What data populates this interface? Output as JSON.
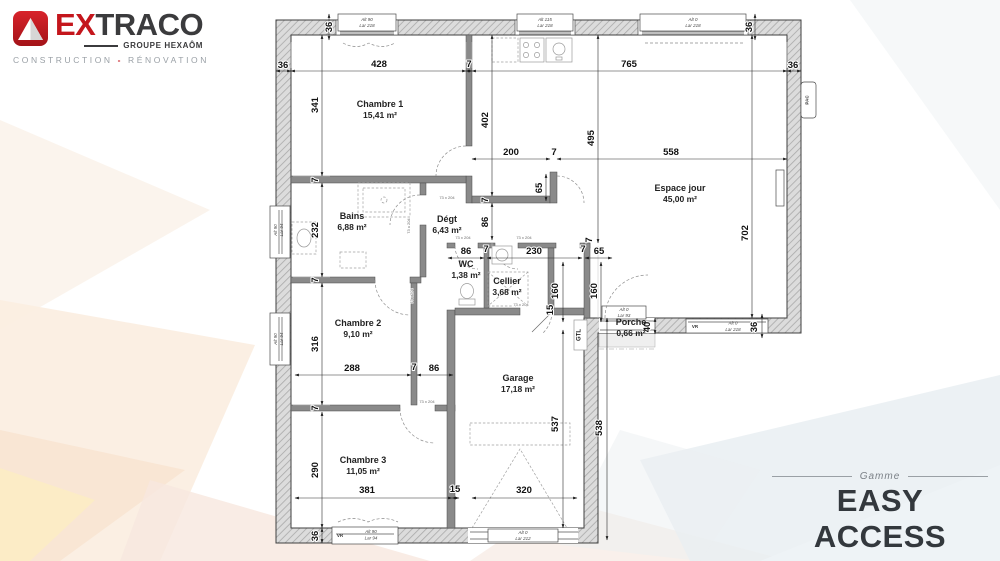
{
  "brand": {
    "name_accent": "EX",
    "name_rest": "TRACO",
    "group": "GROUPE HEXAÔM",
    "tagline_left": "CONSTRUCTION",
    "tagline_sep": "-",
    "tagline_right": "RÉNOVATION"
  },
  "range": {
    "label": "Gamme",
    "name": "EASY ACCESS"
  },
  "colors": {
    "brand_red": "#c4161c",
    "text_dark": "#33383d",
    "wall_gray": "#dcdcdc",
    "dim_text": "#111111"
  },
  "plan": {
    "rooms": [
      {
        "name": "Chambre 1",
        "area": "15,41 m²",
        "x": 380,
        "y": 107
      },
      {
        "name": "Espace jour",
        "area": "45,00 m²",
        "x": 680,
        "y": 191
      },
      {
        "name": "Bains",
        "area": "6,88 m²",
        "x": 352,
        "y": 219
      },
      {
        "name": "Dégt",
        "area": "6,43 m²",
        "x": 447,
        "y": 222
      },
      {
        "name": "WC",
        "area": "1,38 m²",
        "x": 466,
        "y": 267
      },
      {
        "name": "Cellier",
        "area": "3,68 m²",
        "x": 507,
        "y": 284
      },
      {
        "name": "Chambre 2",
        "area": "9,10 m²",
        "x": 358,
        "y": 326
      },
      {
        "name": "Garage",
        "area": "17,18 m²",
        "x": 518,
        "y": 381
      },
      {
        "name": "Chambre 3",
        "area": "11,05 m²",
        "x": 363,
        "y": 463
      },
      {
        "name": "Porche",
        "area": "0,66 m²",
        "x": 631,
        "y": 325
      }
    ],
    "dimensions": [
      {
        "t": "36",
        "x": 283,
        "y": 68
      },
      {
        "t": "428",
        "x": 379,
        "y": 67
      },
      {
        "t": "7",
        "x": 469,
        "y": 67
      },
      {
        "t": "765",
        "x": 629,
        "y": 67
      },
      {
        "t": "36",
        "x": 793,
        "y": 68
      },
      {
        "t": "36",
        "x": 332,
        "y": 27,
        "r": 1
      },
      {
        "t": "36",
        "x": 752,
        "y": 27,
        "r": 1
      },
      {
        "t": "341",
        "x": 318,
        "y": 105,
        "r": 1
      },
      {
        "t": "7",
        "x": 318,
        "y": 180,
        "r": 1
      },
      {
        "t": "232",
        "x": 318,
        "y": 230,
        "r": 1
      },
      {
        "t": "7",
        "x": 318,
        "y": 280,
        "r": 1
      },
      {
        "t": "316",
        "x": 318,
        "y": 344,
        "r": 1
      },
      {
        "t": "7",
        "x": 318,
        "y": 408,
        "r": 1
      },
      {
        "t": "290",
        "x": 318,
        "y": 470,
        "r": 1
      },
      {
        "t": "36",
        "x": 318,
        "y": 536,
        "r": 1
      },
      {
        "t": "402",
        "x": 488,
        "y": 120,
        "r": 1
      },
      {
        "t": "7",
        "x": 488,
        "y": 200,
        "r": 1
      },
      {
        "t": "86",
        "x": 488,
        "y": 222,
        "r": 1
      },
      {
        "t": "495",
        "x": 594,
        "y": 138,
        "r": 1
      },
      {
        "t": "200",
        "x": 511,
        "y": 155
      },
      {
        "t": "7",
        "x": 554,
        "y": 155
      },
      {
        "t": "558",
        "x": 671,
        "y": 155
      },
      {
        "t": "65",
        "x": 542,
        "y": 188,
        "r": 1
      },
      {
        "t": "86",
        "x": 466,
        "y": 254
      },
      {
        "t": "7",
        "x": 486,
        "y": 252
      },
      {
        "t": "230",
        "x": 534,
        "y": 254
      },
      {
        "t": "7",
        "x": 583,
        "y": 252
      },
      {
        "t": "65",
        "x": 599,
        "y": 254
      },
      {
        "t": "160",
        "x": 558,
        "y": 291,
        "r": 1
      },
      {
        "t": "160",
        "x": 597,
        "y": 291,
        "r": 1
      },
      {
        "t": "15",
        "x": 553,
        "y": 310,
        "r": 1
      },
      {
        "t": "7",
        "x": 592,
        "y": 240,
        "r": 1
      },
      {
        "t": "288",
        "x": 352,
        "y": 371
      },
      {
        "t": "7",
        "x": 414,
        "y": 370
      },
      {
        "t": "86",
        "x": 434,
        "y": 371
      },
      {
        "t": "381",
        "x": 367,
        "y": 493
      },
      {
        "t": "15",
        "x": 455,
        "y": 492
      },
      {
        "t": "320",
        "x": 524,
        "y": 493
      },
      {
        "t": "537",
        "x": 558,
        "y": 424,
        "r": 1
      },
      {
        "t": "538",
        "x": 602,
        "y": 428,
        "r": 1
      },
      {
        "t": "702",
        "x": 748,
        "y": 233,
        "r": 1
      },
      {
        "t": "40",
        "x": 650,
        "y": 327,
        "r": 1
      },
      {
        "t": "36",
        "x": 757,
        "y": 327,
        "r": 1
      }
    ],
    "door_labels": [
      {
        "t": "73 x 204",
        "x": 447,
        "y": 199
      },
      {
        "t": "73 x 204",
        "x": 410,
        "y": 226,
        "r": 1
      },
      {
        "t": "73 x 204",
        "x": 413,
        "y": 296,
        "r": 1
      },
      {
        "t": "73 x 204",
        "x": 463,
        "y": 239
      },
      {
        "t": "73 x 204",
        "x": 524,
        "y": 239
      },
      {
        "t": "73 x 204",
        "x": 427,
        "y": 403
      },
      {
        "t": "73 x 204",
        "x": 521,
        "y": 306
      }
    ],
    "small_labels": [
      {
        "t": "Alt 90",
        "x": 367,
        "y": 21
      },
      {
        "t": "Lar 218",
        "x": 367,
        "y": 27
      },
      {
        "t": "Alt 115",
        "x": 545,
        "y": 21
      },
      {
        "t": "Lar 218",
        "x": 545,
        "y": 27
      },
      {
        "t": "Alt 0",
        "x": 693,
        "y": 21
      },
      {
        "t": "Lar 218",
        "x": 693,
        "y": 27
      },
      {
        "t": "Alt 90",
        "x": 277,
        "y": 230,
        "r": 1
      },
      {
        "t": "Lar 94",
        "x": 283,
        "y": 230,
        "r": 1
      },
      {
        "t": "Alt 90",
        "x": 277,
        "y": 339,
        "r": 1
      },
      {
        "t": "Lar 94",
        "x": 283,
        "y": 339,
        "r": 1
      },
      {
        "t": "VR",
        "x": 340,
        "y": 537,
        "c": "tinyb"
      },
      {
        "t": "Alt 90",
        "x": 371,
        "y": 533
      },
      {
        "t": "Lar 94",
        "x": 371,
        "y": 539.5
      },
      {
        "t": "VR",
        "x": 695,
        "y": 328,
        "c": "tinyb"
      },
      {
        "t": "Alt 0",
        "x": 733,
        "y": 324.5
      },
      {
        "t": "Lar 218",
        "x": 733,
        "y": 331
      },
      {
        "t": "Alt 0",
        "x": 624,
        "y": 311
      },
      {
        "t": "Lar 93",
        "x": 624,
        "y": 317
      },
      {
        "t": "Alt 0",
        "x": 523,
        "y": 534
      },
      {
        "t": "Lar 212",
        "x": 523,
        "y": 540
      },
      {
        "t": "GTL",
        "x": 580.5,
        "y": 335,
        "r": 1,
        "c": "gtlt"
      },
      {
        "t": "PAC",
        "x": 808.5,
        "y": 100,
        "r": 1,
        "c": "tinyb"
      }
    ]
  }
}
